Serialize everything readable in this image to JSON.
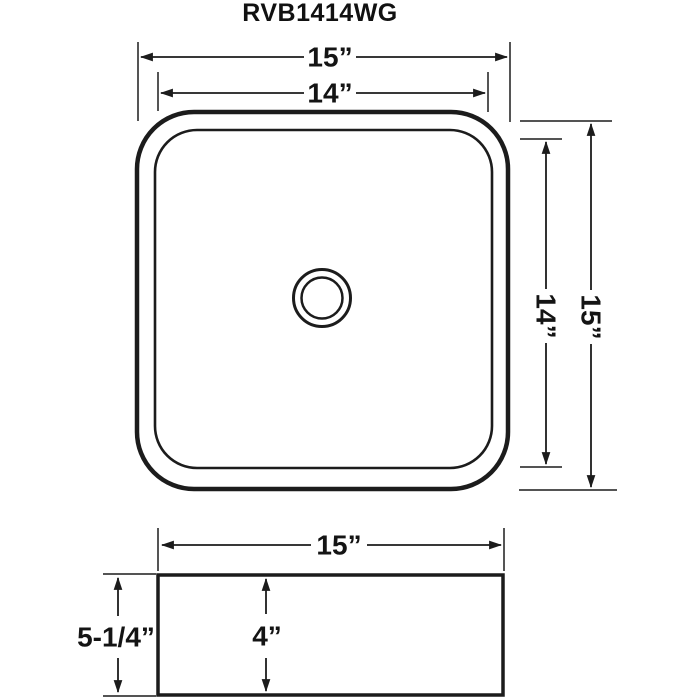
{
  "title": "RVB1414WG",
  "views": {
    "top": {
      "outer_width": "15”",
      "inner_width": "14”",
      "inner_height": "14”",
      "outer_height": "15”"
    },
    "front": {
      "width": "15”",
      "height": "5-1/4”",
      "depth": "4”"
    }
  },
  "colors": {
    "line": "#1c1c1c",
    "text": "#141414",
    "background": "#ffffff"
  }
}
